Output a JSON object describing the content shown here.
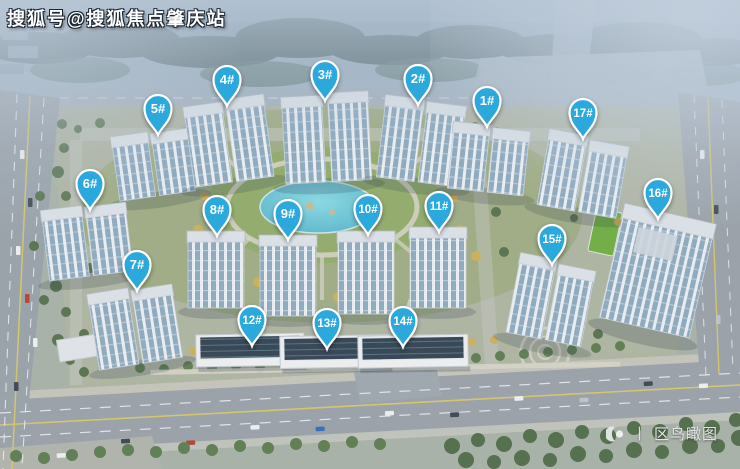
{
  "watermark": {
    "text": "搜狐号@搜狐焦点肇庆站"
  },
  "caption": {
    "separator": "丨",
    "text": "区鸟瞰图"
  },
  "marker_style": {
    "fill": "#2BA9DD",
    "border": "#FFFFFF",
    "text_color": "#FFFFFF"
  },
  "markers": [
    {
      "label": "1#",
      "x": 487,
      "y": 100
    },
    {
      "label": "2#",
      "x": 418,
      "y": 78
    },
    {
      "label": "3#",
      "x": 325,
      "y": 74
    },
    {
      "label": "4#",
      "x": 227,
      "y": 79
    },
    {
      "label": "5#",
      "x": 158,
      "y": 108
    },
    {
      "label": "6#",
      "x": 90,
      "y": 183
    },
    {
      "label": "7#",
      "x": 137,
      "y": 264
    },
    {
      "label": "8#",
      "x": 217,
      "y": 209
    },
    {
      "label": "9#",
      "x": 288,
      "y": 213
    },
    {
      "label": "10#",
      "x": 368,
      "y": 208
    },
    {
      "label": "11#",
      "x": 439,
      "y": 205
    },
    {
      "label": "12#",
      "x": 252,
      "y": 319
    },
    {
      "label": "13#",
      "x": 327,
      "y": 322
    },
    {
      "label": "14#",
      "x": 403,
      "y": 320
    },
    {
      "label": "15#",
      "x": 552,
      "y": 238
    },
    {
      "label": "16#",
      "x": 658,
      "y": 192
    },
    {
      "label": "17#",
      "x": 583,
      "y": 112
    }
  ]
}
